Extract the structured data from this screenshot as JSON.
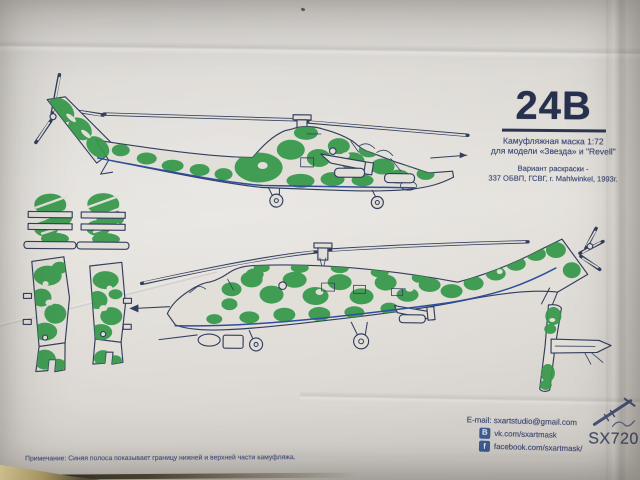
{
  "colors": {
    "paper": "#e2dfd9",
    "ink": "#333e5e",
    "ink_soft": "#47527a",
    "camo_green": "#36984a",
    "boundary_blue": "#2d4f9e",
    "social_blue": "#3b5b94",
    "note_blue": "#565f8c",
    "desk_tan": "#a89a6e",
    "desk_dark": "#2a261f",
    "sx_gray": "#46526e"
  },
  "title_block": {
    "code": "24B",
    "subtitle_line1": "Камуфляжная маска 1:72",
    "subtitle_line2": "для модели «Звезда» и \"Revell\"",
    "variant_line1": "Вариант раскраски -",
    "variant_line2": "337 ОБВП, ГСВГ, г. Mahlwinkel, 1993г."
  },
  "note_text": "Примечание: Синяя полоса показывает границу нижней и верхней части камуфляжа.",
  "contact": {
    "email": "E-mail: sxartstudio@gmail.com",
    "vk_icon": "B",
    "vk_label": "vk.com/sxartmask",
    "facebook_icon": "f",
    "facebook_label": "facebook.com/sxartmask/",
    "product_code": "SX720"
  }
}
